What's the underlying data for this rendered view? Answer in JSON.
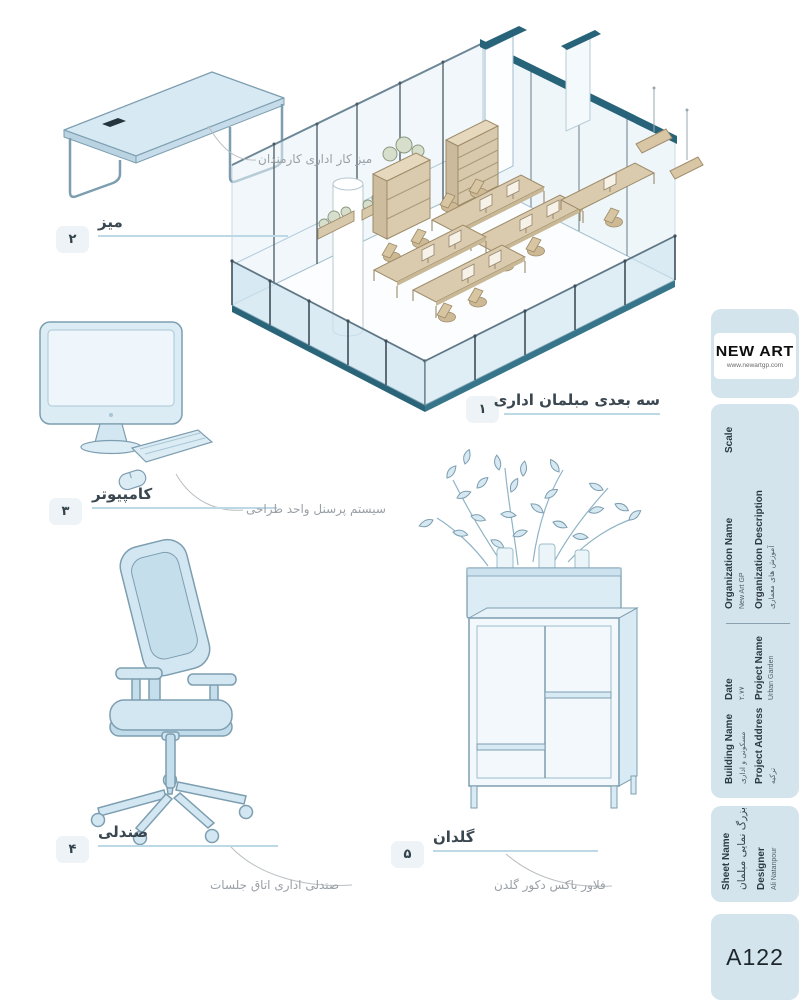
{
  "drawing": {
    "items": [
      {
        "num": "۱",
        "label": "سه بعدی مبلمان اداری",
        "callout": ""
      },
      {
        "num": "۲",
        "label": "میز",
        "callout": "میز کار اداری کارمندان"
      },
      {
        "num": "۳",
        "label": "کامپیوتر",
        "callout": "سیستم پرسنل واحد طراحی"
      },
      {
        "num": "۴",
        "label": "صندلی",
        "callout": "صندلی اداری اتاق جلسات"
      },
      {
        "num": "۵",
        "label": "گلدان",
        "callout": "فلاور باکس دکور گلدن"
      }
    ]
  },
  "titleblock": {
    "logo": {
      "name": "NEW ART",
      "website": "www.newartgp.com"
    },
    "scale": {
      "label": "Scale"
    },
    "organization": {
      "label": "Organization Name",
      "value": "New Art GP"
    },
    "organization_description": {
      "label": "Organization Description",
      "value": "آموزش های معماری"
    },
    "date": {
      "label": "Date",
      "value": "۲.۷۷"
    },
    "project_name": {
      "label": "Project Name",
      "value": "Urban Garden"
    },
    "building_name": {
      "label": "Building Name",
      "value": "مسکونی و اداری"
    },
    "project_address": {
      "label": "Project Address",
      "value": "ترکیه"
    },
    "sheet_name": {
      "label": "Sheet Name",
      "value": "بزرگ نمایی مبلمان"
    },
    "designer": {
      "label": "Designer",
      "value": "Ali Natanpour"
    },
    "sheet_number": "A122"
  },
  "colors": {
    "panel_blue": "#d3e4ec",
    "illustration_fill": "#d3e7f2",
    "illustration_outline": "#7d9eb0",
    "teal_accent": "#276379",
    "wood_tan": "#d9c9ac",
    "label_text": "#3a4750",
    "callout_text": "#99a0a6",
    "underline_blue": "#bdd9e6"
  }
}
